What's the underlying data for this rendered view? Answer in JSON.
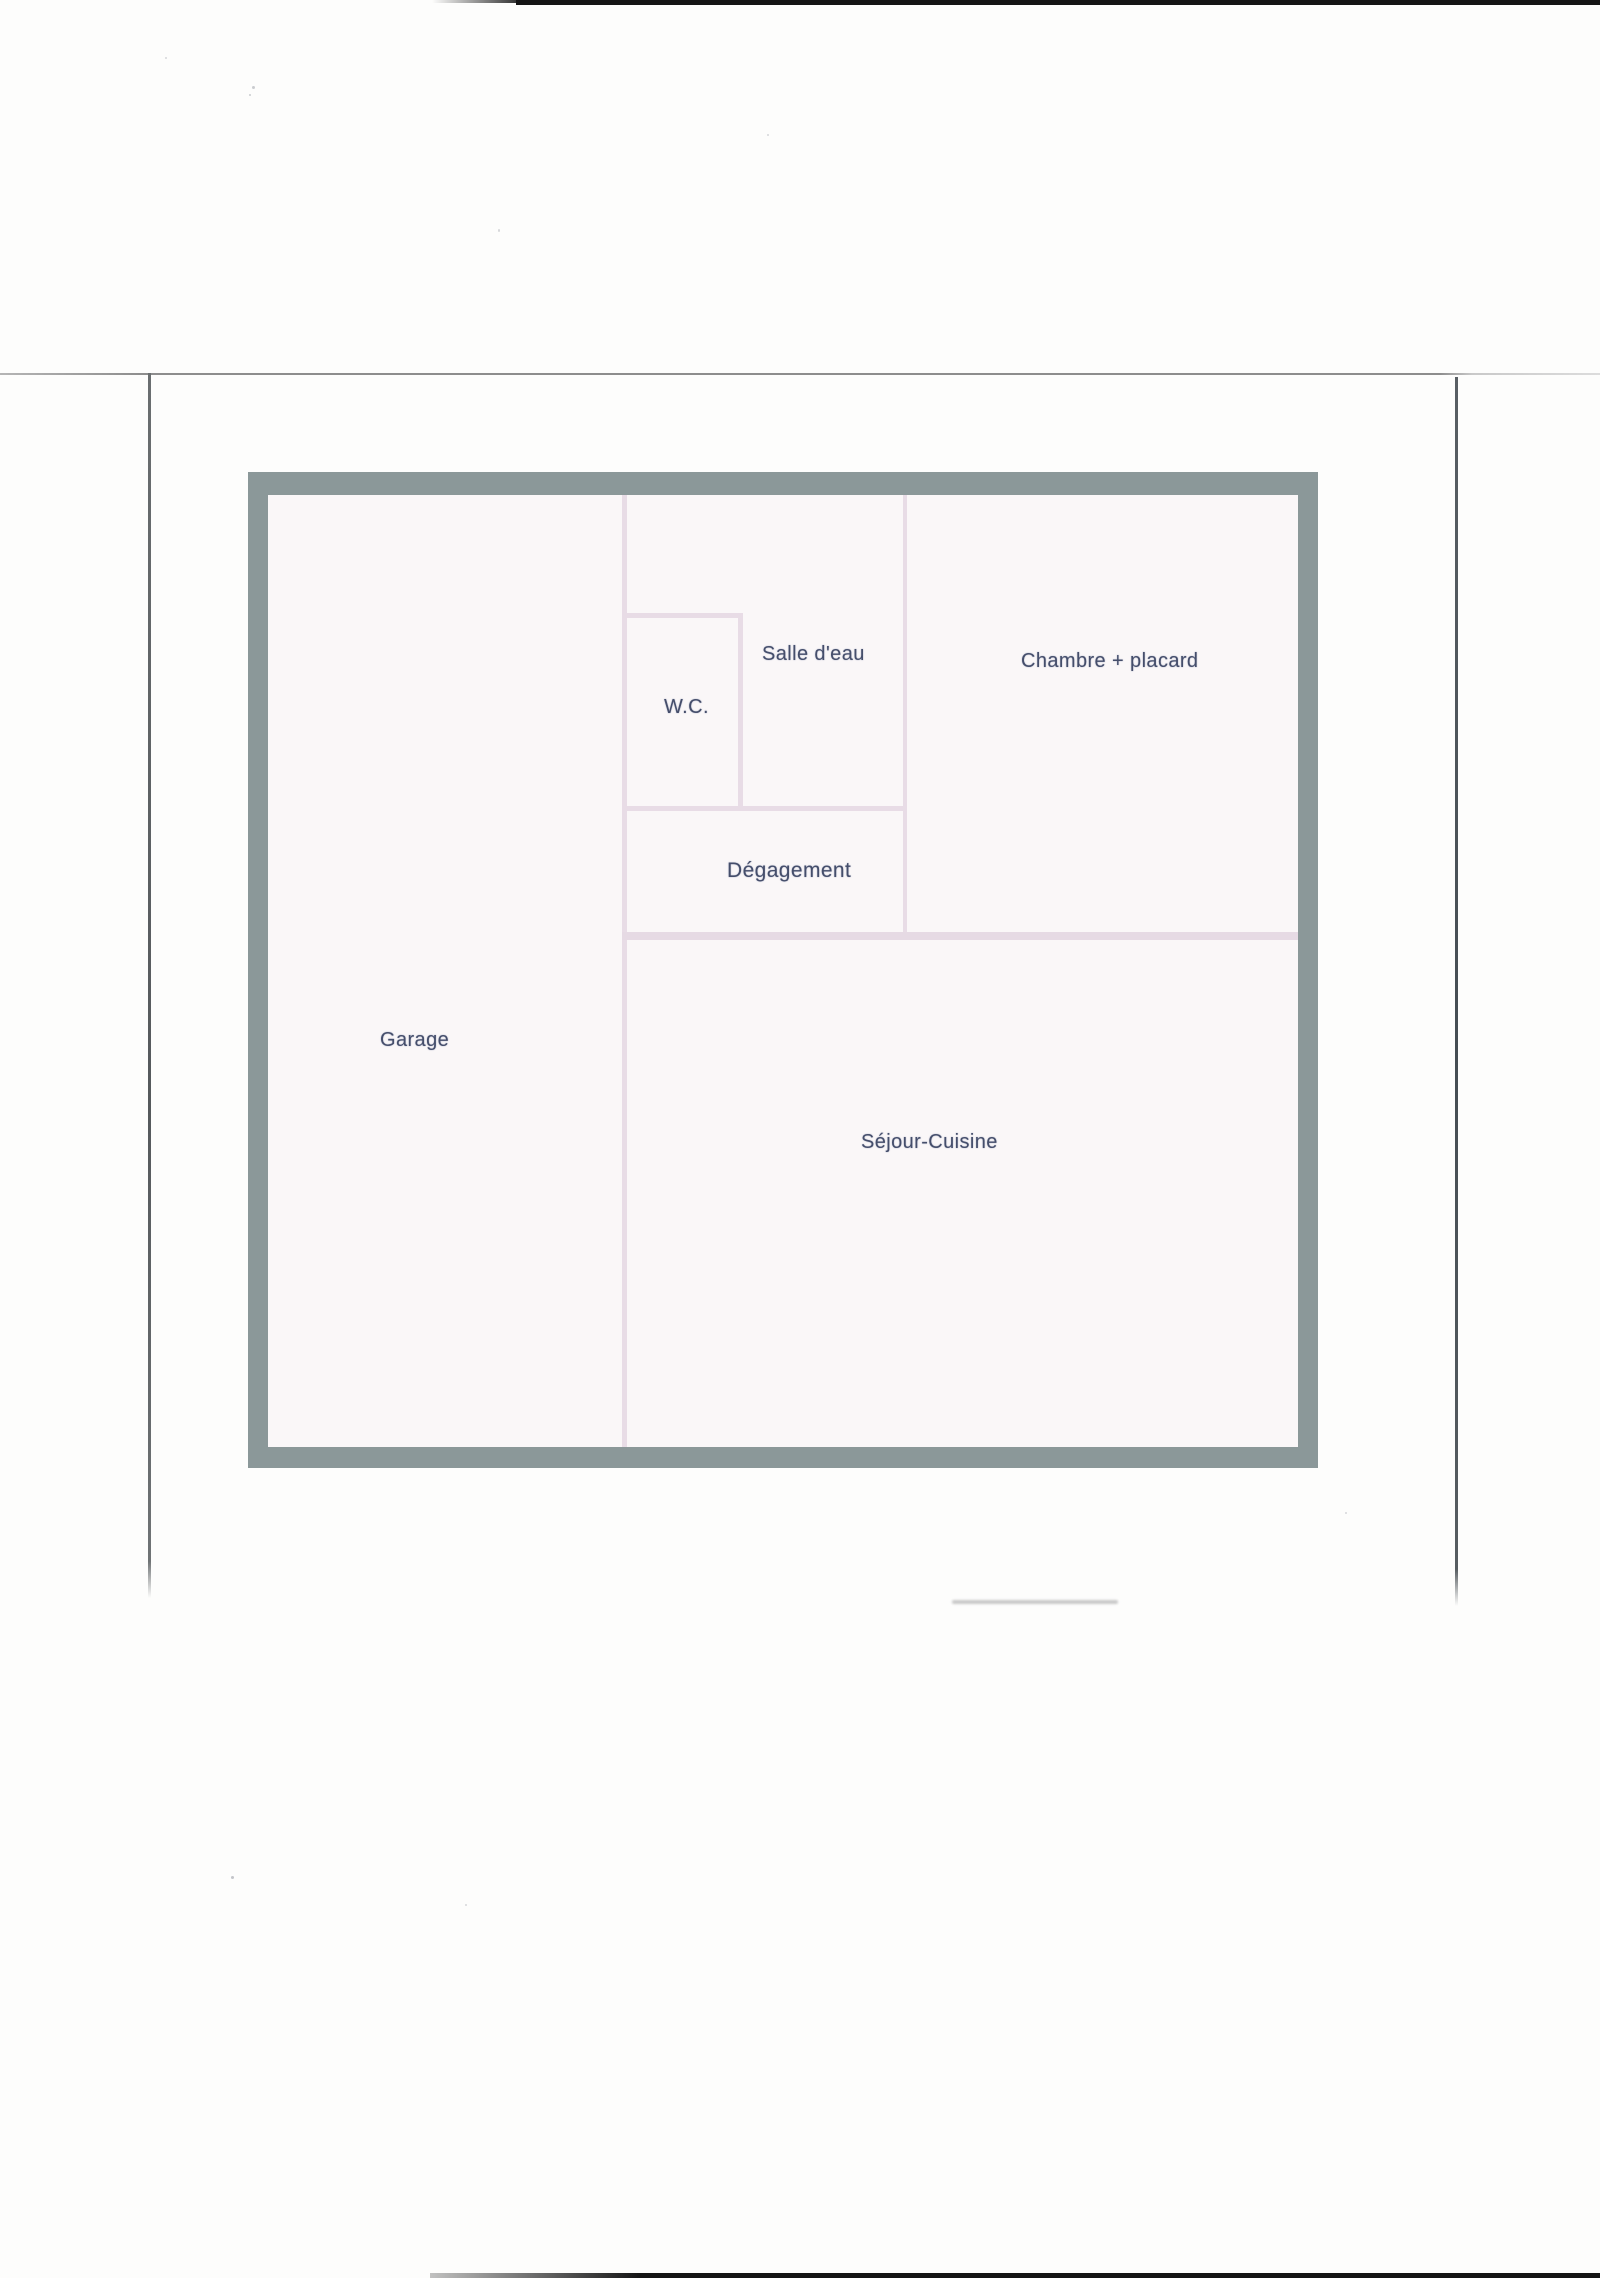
{
  "document": {
    "type": "scanned-floor-plan-page",
    "background_color": "#fdfdfc"
  },
  "scan_artifacts": {
    "top_edge_bar_color": "#151515",
    "bottom_edge_bar_color": "#141414",
    "frame_line_color": "#8d8d8d",
    "left_guide_line_color": "#55595c",
    "right_guide_line_color": "#454d53",
    "smudge_color": "#bdbdbd"
  },
  "floorplan": {
    "outer_wall_color": "#8b9899",
    "floor_color": "#faf7f8",
    "inner_wall_color": "#e8dce6",
    "label_color": "#454e6b",
    "rooms": [
      {
        "id": "garage",
        "label": "Garage"
      },
      {
        "id": "wc",
        "label": "W.C."
      },
      {
        "id": "salle-deau",
        "label": "Salle d'eau"
      },
      {
        "id": "chambre-placard",
        "label": "Chambre + placard"
      },
      {
        "id": "degagement",
        "label": "Dégagement"
      },
      {
        "id": "sejour-cuisine",
        "label": "Séjour-Cuisine"
      }
    ]
  }
}
